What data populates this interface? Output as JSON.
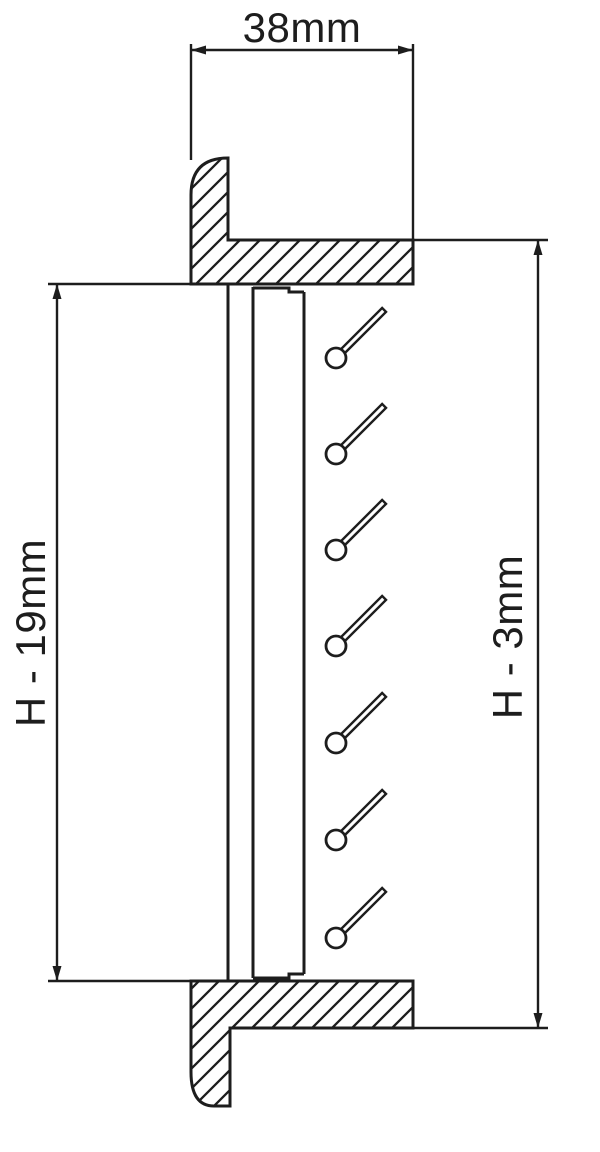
{
  "drawing": {
    "type": "technical-section",
    "description": "Side cross-section of a louver vent frame with angled blades and dimension callouts",
    "background": "#ffffff",
    "ink": "#1d1d1d",
    "labels": {
      "width": "38mm",
      "opening_height": "H - 19mm",
      "overall_height": "H - 3mm"
    },
    "blades": {
      "count": 7,
      "cx": 336,
      "r": 10,
      "ys": [
        358,
        454,
        550,
        646,
        743,
        840,
        938
      ],
      "angle_deg": 45,
      "shaft_len": 61,
      "shaft_w": 5.5,
      "shaft_offset": 7
    }
  }
}
